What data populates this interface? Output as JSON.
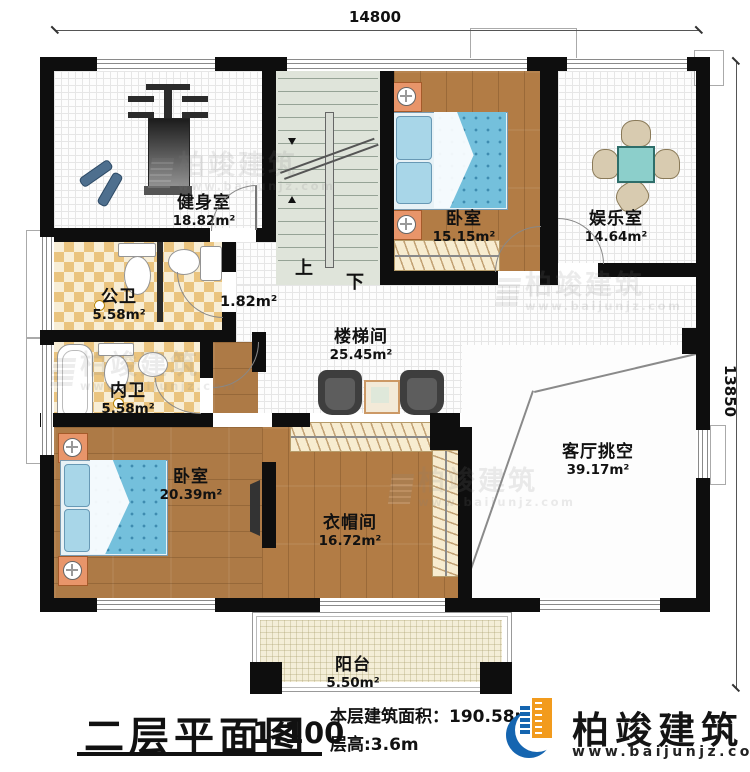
{
  "dimensions": {
    "top": "14800",
    "right": "13850"
  },
  "rooms": {
    "gym": {
      "name": "健身室",
      "area": "18.82m²"
    },
    "bedroom_top": {
      "name": "卧室",
      "area": "15.15m²"
    },
    "entertainment": {
      "name": "娱乐室",
      "area": "14.64m²"
    },
    "public_bath": {
      "name": "公卫",
      "area": "5.58m²"
    },
    "private_bath": {
      "name": "内卫",
      "area": "5.58m²"
    },
    "stair_hall": {
      "name": "楼梯间",
      "area": "25.45m²"
    },
    "corridor": {
      "area": "1.82m²"
    },
    "bedroom_bottom": {
      "name": "卧室",
      "area": "20.39m²"
    },
    "cloakroom": {
      "name": "衣帽间",
      "area": "16.72m²"
    },
    "living_void": {
      "name": "客厅挑空",
      "area": "39.17m²"
    },
    "balcony": {
      "name": "阳台",
      "area": "5.50m²"
    }
  },
  "stairs": {
    "up": "上",
    "down": "下"
  },
  "title_block": {
    "title": "二层平面图",
    "scale": "1:100",
    "area_line": "本层建筑面积：190.58m²",
    "height_line": "层高:3.6m"
  },
  "brand": {
    "name": "柏竣建筑",
    "website": "www.baijunjz.com"
  },
  "watermark": {
    "name": "柏竣建筑",
    "website": "www.baijunjz.com"
  },
  "colors": {
    "wall": "#0e0e0e",
    "wood": "#b27c45",
    "mattress_blue": "#74c0dc",
    "tile_tan": "#eac47f",
    "nightstand_orange": "#e8956a",
    "table_teal": "#8ccfcb",
    "logo_blue": "#1565b0",
    "logo_orange": "#f29b1d"
  }
}
